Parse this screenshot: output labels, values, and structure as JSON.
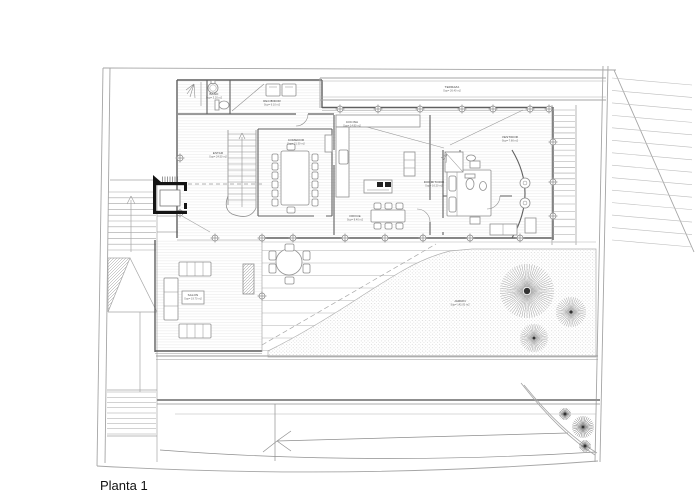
{
  "title": "Planta 1",
  "palette": {
    "line": "#a5a5a5",
    "wall": "#5f5f5f",
    "furniture": "#8f8f8f",
    "black": "#141414",
    "paper": "#ffffff"
  },
  "labels": {
    "bano": {
      "name": "BAÑO",
      "area": "Sup= 3.20 m2"
    },
    "recibidor": {
      "name": "RECIBIDOR",
      "area": "Sup= 6.10 m2"
    },
    "estar": {
      "name": "ESTAR",
      "area": "Sup= 24.50 m2"
    },
    "comedor": {
      "name": "COMEDOR",
      "area": "Sup= 21.30 m2"
    },
    "cocina": {
      "name": "COCINA",
      "area": "Sup= 14.80 m2"
    },
    "office": {
      "name": "OFFICE",
      "area": "Sup= 8.40 m2"
    },
    "dormitorio": {
      "name": "DORMITORIO",
      "area": "Sup= 16.20 m2"
    },
    "vestidor": {
      "name": "VESTIDOR",
      "area": "Sup= 7.60 m2"
    },
    "terraza": {
      "name": "TERRAZA",
      "area": "Sup= 26.40 m2"
    },
    "salon": {
      "name": "SALON",
      "area": "Sup= 19.70 m2"
    },
    "jardin": {
      "name": "JARDIN",
      "area": "Sup= 142.00 m2"
    }
  }
}
